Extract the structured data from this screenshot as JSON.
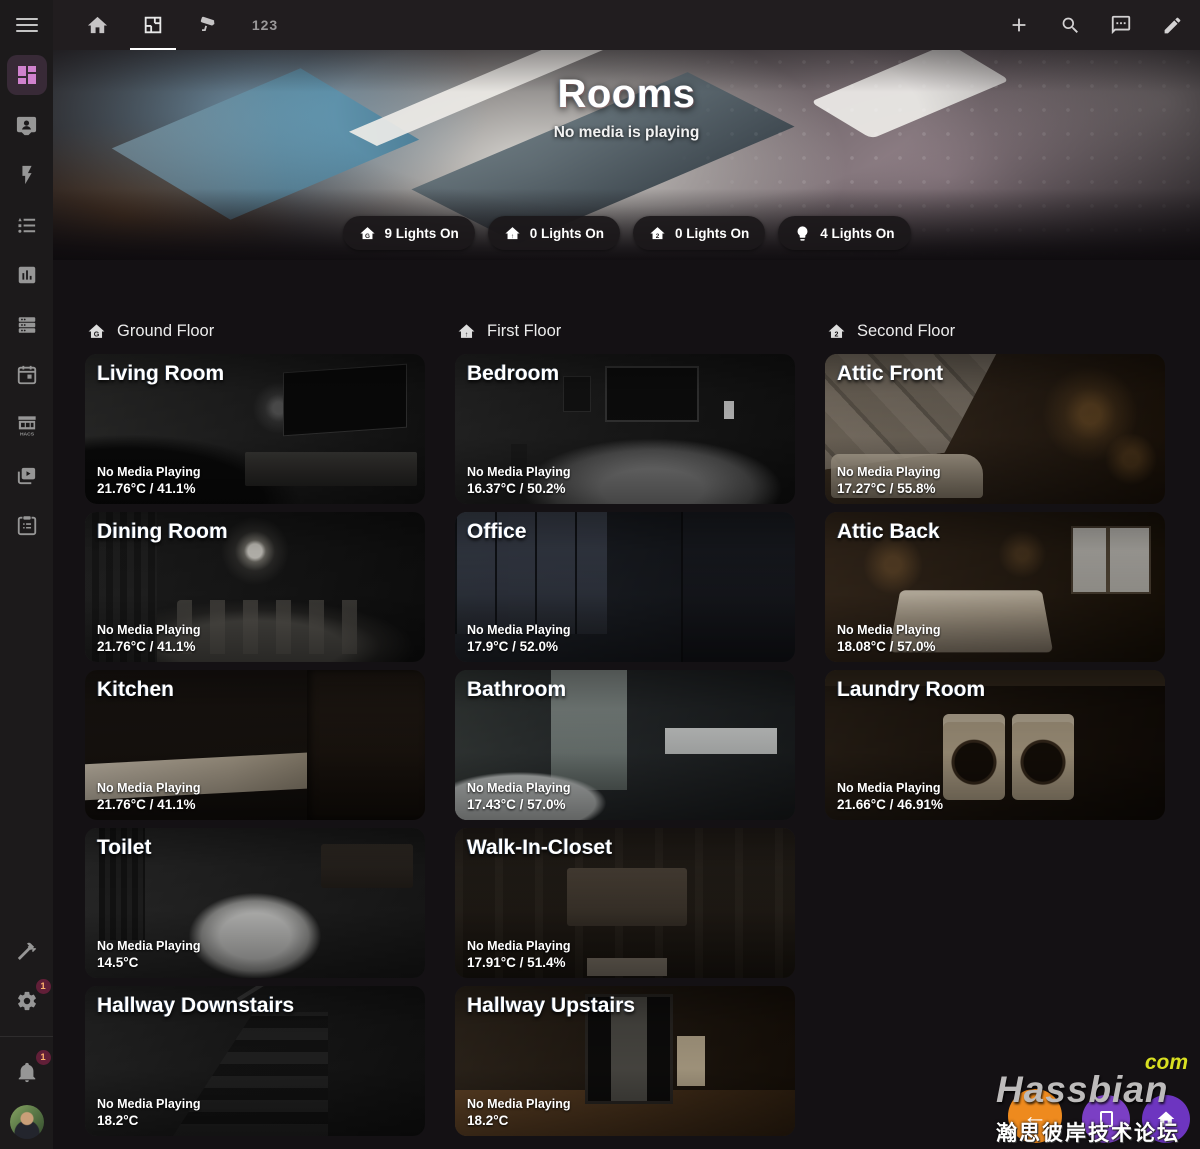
{
  "topbar": {
    "tab123": "123"
  },
  "sidebar": {
    "hacs_label": "HACS"
  },
  "badges": {
    "settings": "1",
    "notifications": "1"
  },
  "hero": {
    "title": "Rooms",
    "subtitle": "No media is playing",
    "chips": [
      {
        "glyph": "G",
        "label": "9 Lights On"
      },
      {
        "glyph": "↑",
        "label": "0 Lights On"
      },
      {
        "glyph": "2",
        "label": "0 Lights On"
      },
      {
        "label": "4 Lights On"
      }
    ]
  },
  "columns": [
    {
      "heading": "Ground Floor",
      "floor_glyph": "G",
      "rooms": [
        {
          "name": "Living Room",
          "media": "No Media Playing",
          "climate": "21.76°C / 41.1%"
        },
        {
          "name": "Dining Room",
          "media": "No Media Playing",
          "climate": "21.76°C / 41.1%"
        },
        {
          "name": "Kitchen",
          "media": "No Media Playing",
          "climate": "21.76°C / 41.1%"
        },
        {
          "name": "Toilet",
          "media": "No Media Playing",
          "climate": "14.5°C"
        },
        {
          "name": "Hallway Downstairs",
          "media": "No Media Playing",
          "climate": "18.2°C"
        }
      ]
    },
    {
      "heading": "First Floor",
      "floor_glyph": "↑",
      "rooms": [
        {
          "name": "Bedroom",
          "media": "No Media Playing",
          "climate": "16.37°C / 50.2%"
        },
        {
          "name": "Office",
          "media": "No Media Playing",
          "climate": "17.9°C / 52.0%"
        },
        {
          "name": "Bathroom",
          "media": "No Media Playing",
          "climate": "17.43°C / 57.0%"
        },
        {
          "name": "Walk-In-Closet",
          "media": "No Media Playing",
          "climate": "17.91°C / 51.4%"
        },
        {
          "name": "Hallway Upstairs",
          "media": "No Media Playing",
          "climate": "18.2°C"
        }
      ]
    },
    {
      "heading": "Second Floor",
      "floor_glyph": "2",
      "rooms": [
        {
          "name": "Attic Front",
          "media": "No Media Playing",
          "climate": "17.27°C / 55.8%"
        },
        {
          "name": "Attic Back",
          "media": "No Media Playing",
          "climate": "18.08°C / 57.0%"
        },
        {
          "name": "Laundry Room",
          "media": "No Media Playing",
          "climate": "21.66°C / 46.91%"
        }
      ]
    }
  ],
  "watermark": {
    "brand": "Hassbian",
    "tld": "com",
    "forum": "瀚思彼岸技术论坛"
  }
}
